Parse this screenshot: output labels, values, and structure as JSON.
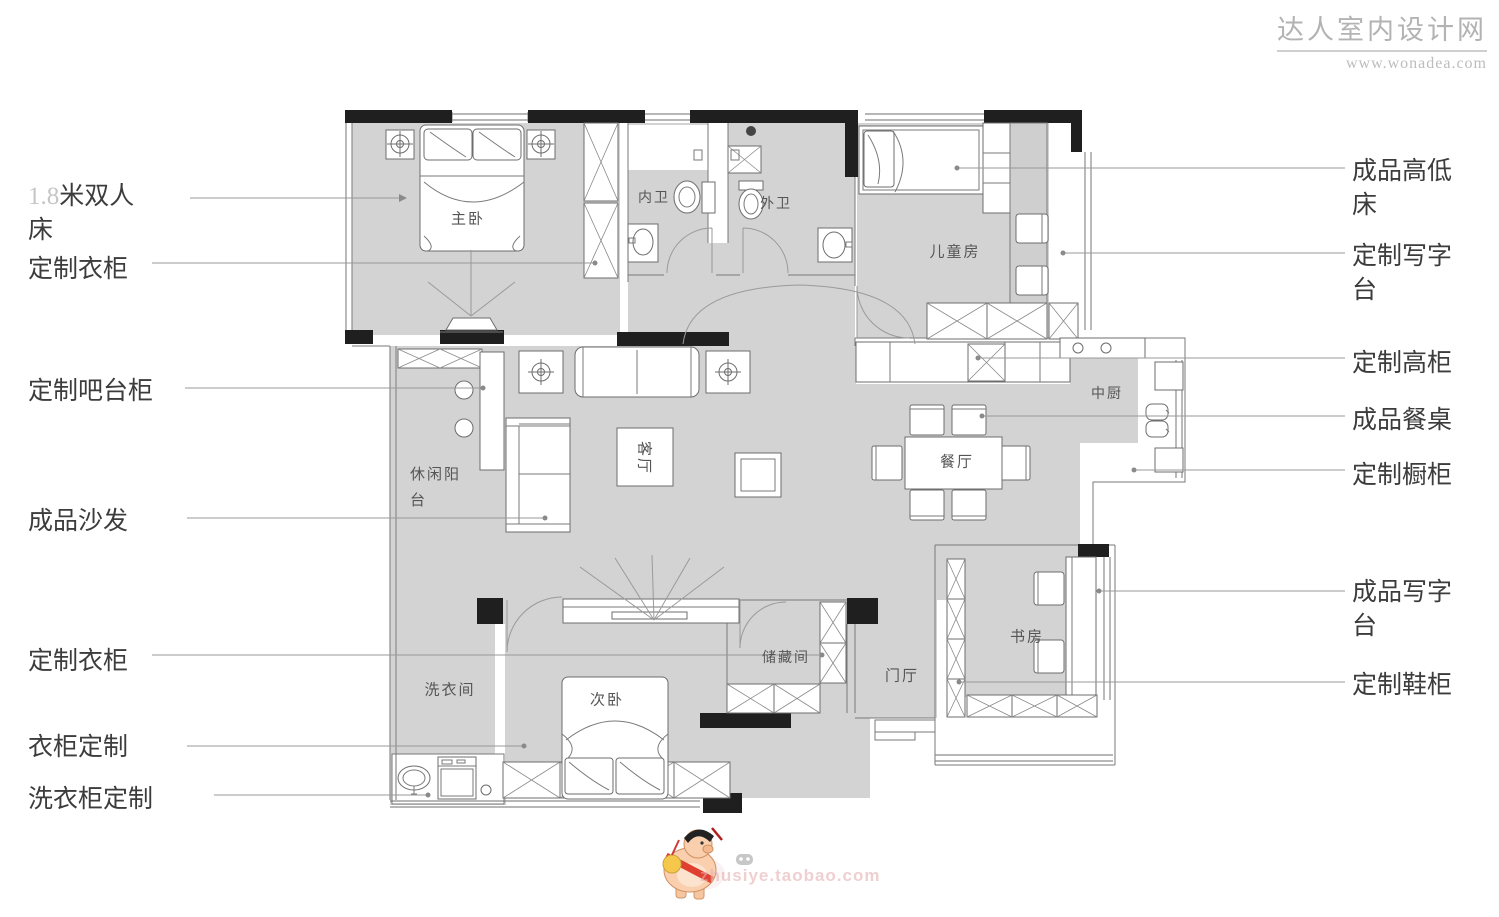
{
  "header": {
    "site_name": "达人室内设计网",
    "site_url": "www.wonadea.com"
  },
  "annotations_left": [
    {
      "prefix": "1.8",
      "label": "米双人床"
    },
    {
      "label": "定制衣柜"
    },
    {
      "label": "定制吧台柜"
    },
    {
      "label": "成品沙发"
    },
    {
      "label": "定制衣柜"
    },
    {
      "label": "衣柜定制"
    },
    {
      "label": "洗衣柜定制"
    }
  ],
  "annotations_right": [
    {
      "label": "成品高低床"
    },
    {
      "label": "定制写字台"
    },
    {
      "label": "定制高柜"
    },
    {
      "label": "成品餐桌"
    },
    {
      "label": "定制橱柜"
    },
    {
      "label": "成品写字台"
    },
    {
      "label": "定制鞋柜"
    }
  ],
  "rooms": {
    "master_bedroom": "主卧",
    "inner_bathroom": "内卫",
    "outer_bathroom": "外卫",
    "kids_room": "儿童房",
    "kitchen": "中厨",
    "dining_room": "餐厅",
    "living_room": "客厅",
    "balcony": "休闲阳台",
    "laundry_room": "洗衣间",
    "second_bedroom": "次卧",
    "storage_room": "储藏间",
    "foyer": "门厅",
    "study": "书房"
  },
  "footer": {
    "shop_watermark": "zhusiye.taobao.com"
  },
  "colors": {
    "floor_gray": "#d3d3d3",
    "wall_black": "#1f1f1f",
    "annotation_text": "#3c3c3c",
    "watermark_gray": "#b3b3b3"
  }
}
